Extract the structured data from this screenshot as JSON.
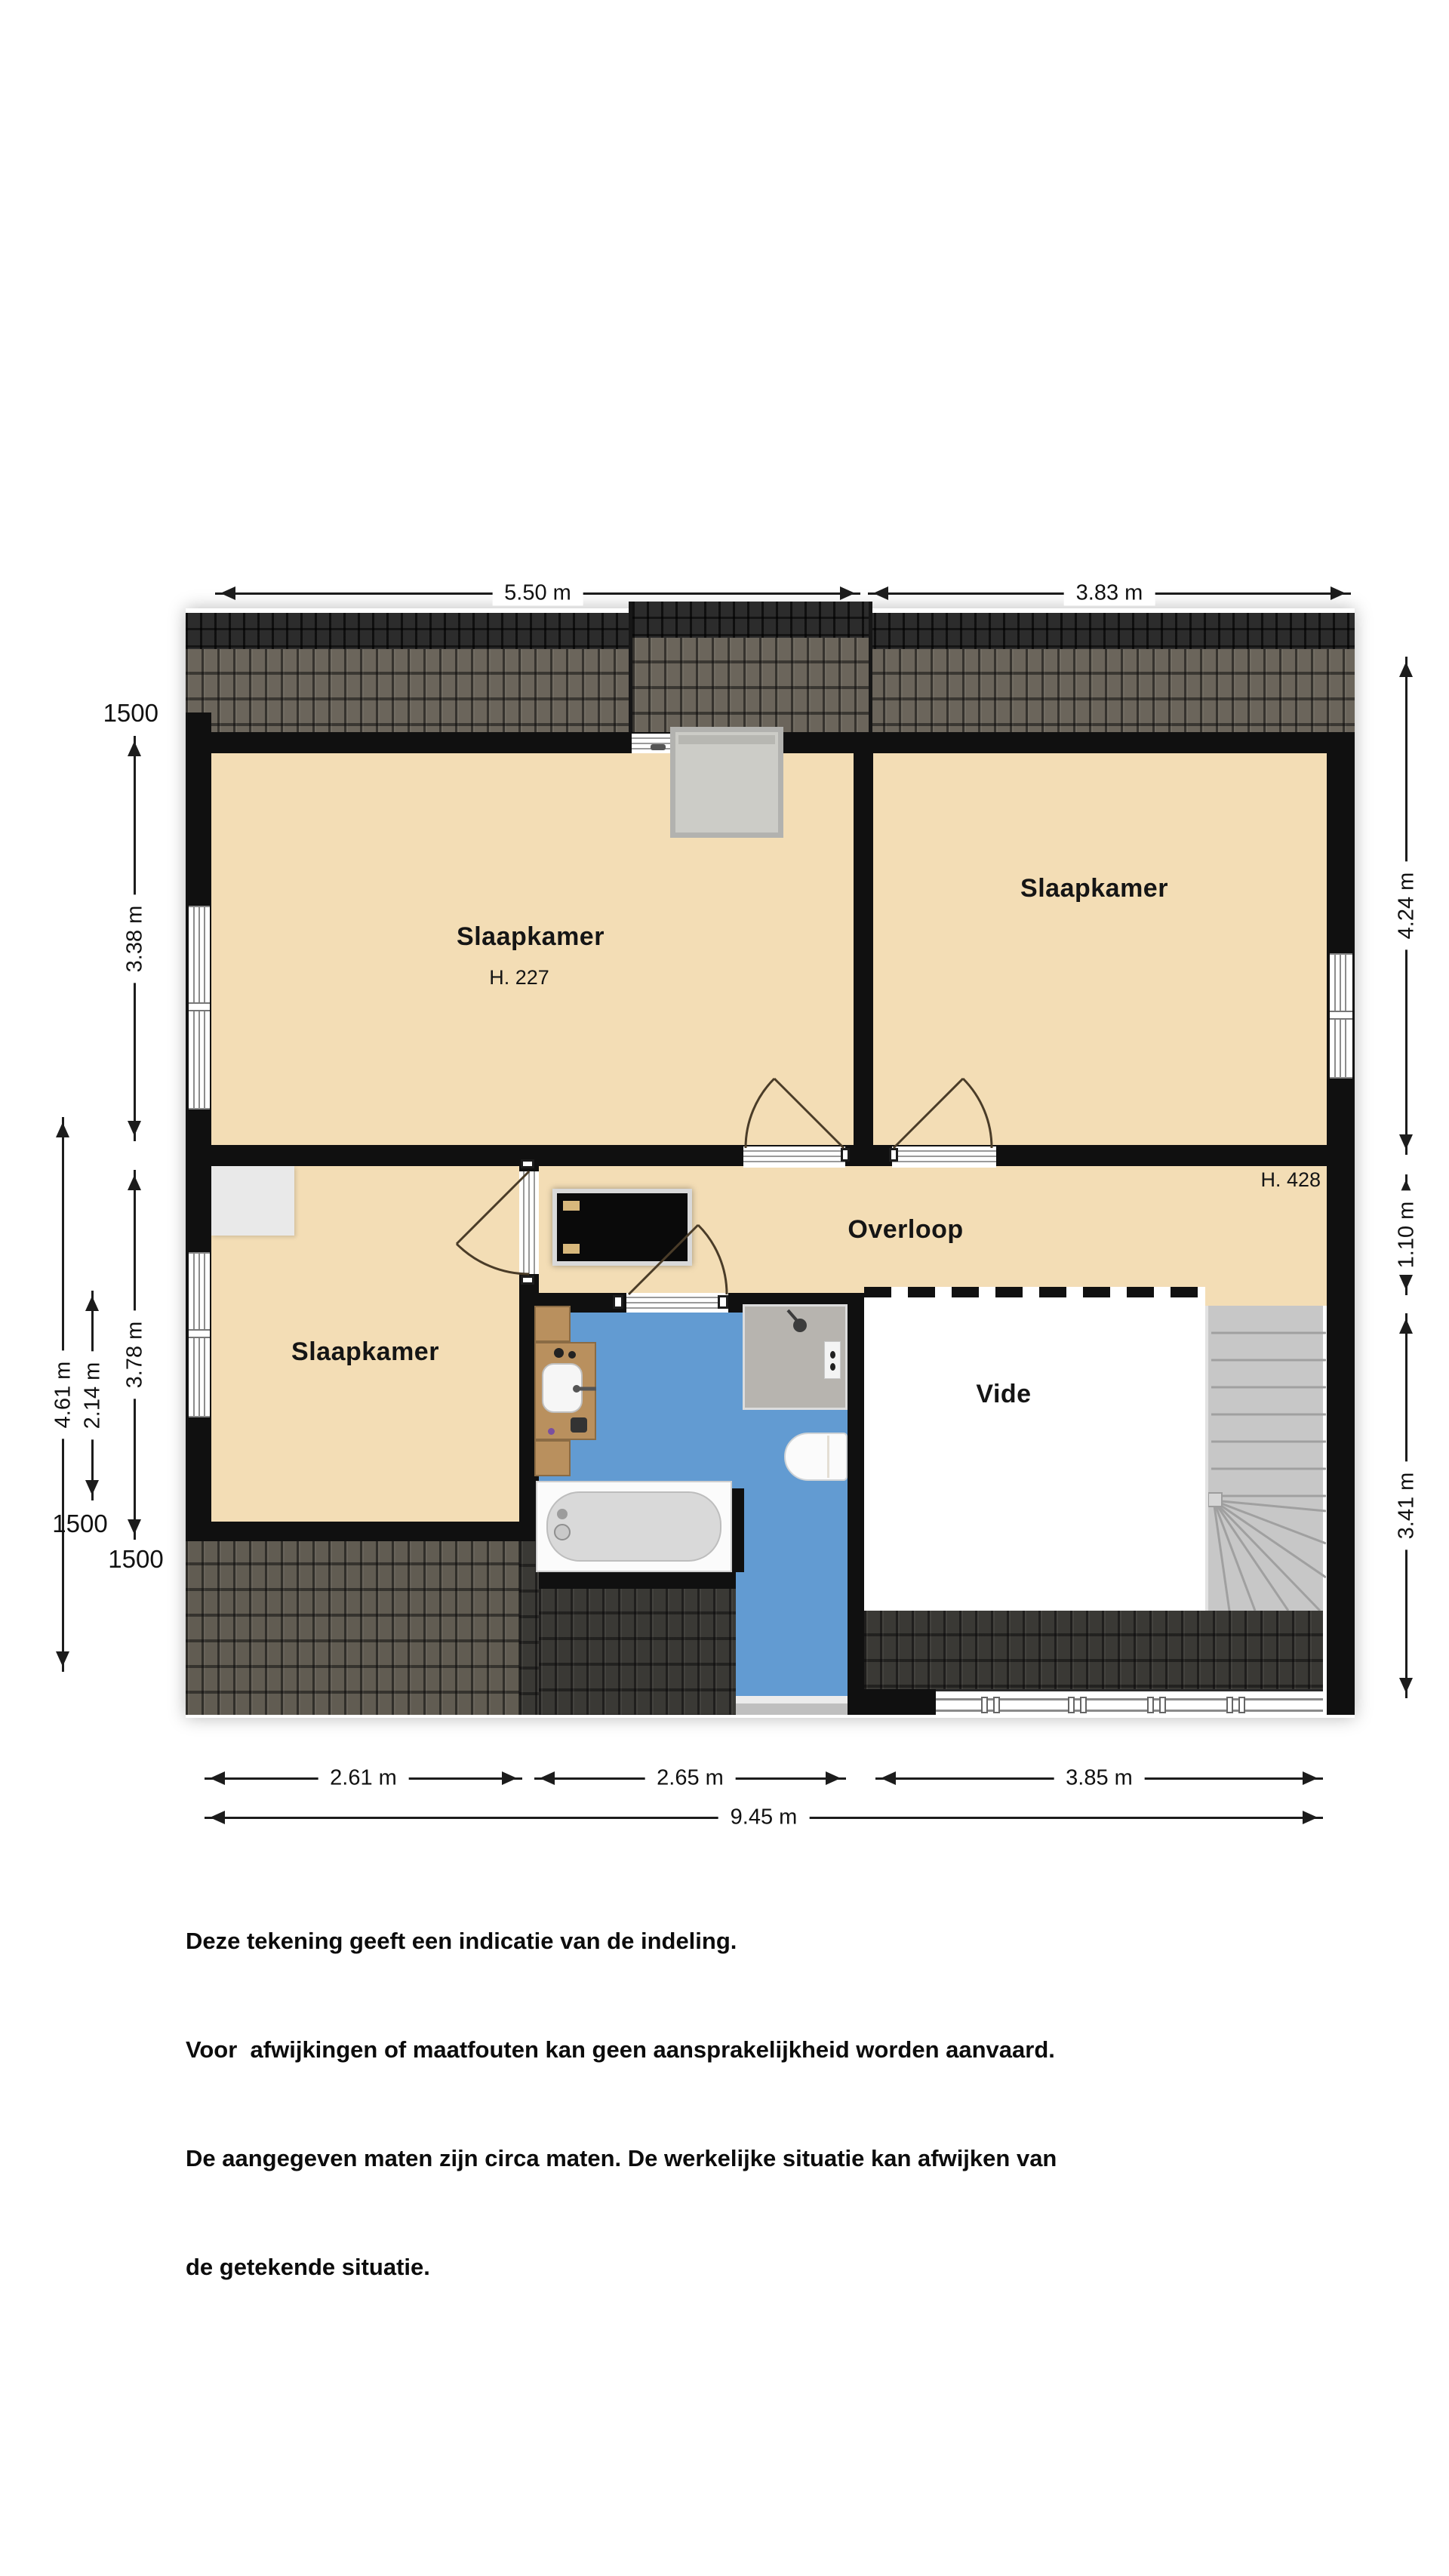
{
  "title": "Floor plan – first floor (verdieping)",
  "rooms": {
    "bedroom_top_left": {
      "label": "Slaapkamer",
      "ceiling_height": "H. 227"
    },
    "bedroom_top_right": {
      "label": "Slaapkamer"
    },
    "bedroom_bottom_left": {
      "label": "Slaapkamer"
    },
    "landing": {
      "label": "Overloop",
      "ceiling_height": "H. 428"
    },
    "void": {
      "label": "Vide"
    }
  },
  "dimensions": {
    "top": {
      "left_section": "5.50 m",
      "right_section": "3.83 m"
    },
    "right": {
      "upper": "4.24 m",
      "middle": "1.10 m",
      "lower": "3.41 m"
    },
    "bottom": {
      "section_1": "2.61 m",
      "section_2": "2.65 m",
      "section_3": "3.85 m",
      "total": "9.45 m"
    },
    "left": {
      "upper_inner": "3.38 m",
      "lower_inner": "3.78 m",
      "lower_outer": "4.61 m",
      "lower_middle": "2.14 m",
      "marker_top": "1500",
      "marker_a": "1500",
      "marker_b": "1500"
    }
  },
  "disclaimer": {
    "line1": "Deze tekening geeft een indicatie van de indeling.",
    "line2": "Voor  afwijkingen of maatfouten kan geen aansprakelijkheid worden aanvaard.",
    "line3": "De aangegeven maten zijn circa maten. De werkelijke situatie kan afwijken van",
    "line4": "de getekende situatie."
  },
  "colors": {
    "room_floor": "#f3ddb5",
    "bathroom_floor": "#629bd2",
    "wall": "#101010",
    "roof_ridge": "#2c2c2c",
    "roof_tiles": "#6b655b",
    "stairs": "#c7c7c7",
    "void_floor": "#ffffff",
    "recess": "#e9e9e9",
    "vanity_wood": "#b9905e"
  }
}
